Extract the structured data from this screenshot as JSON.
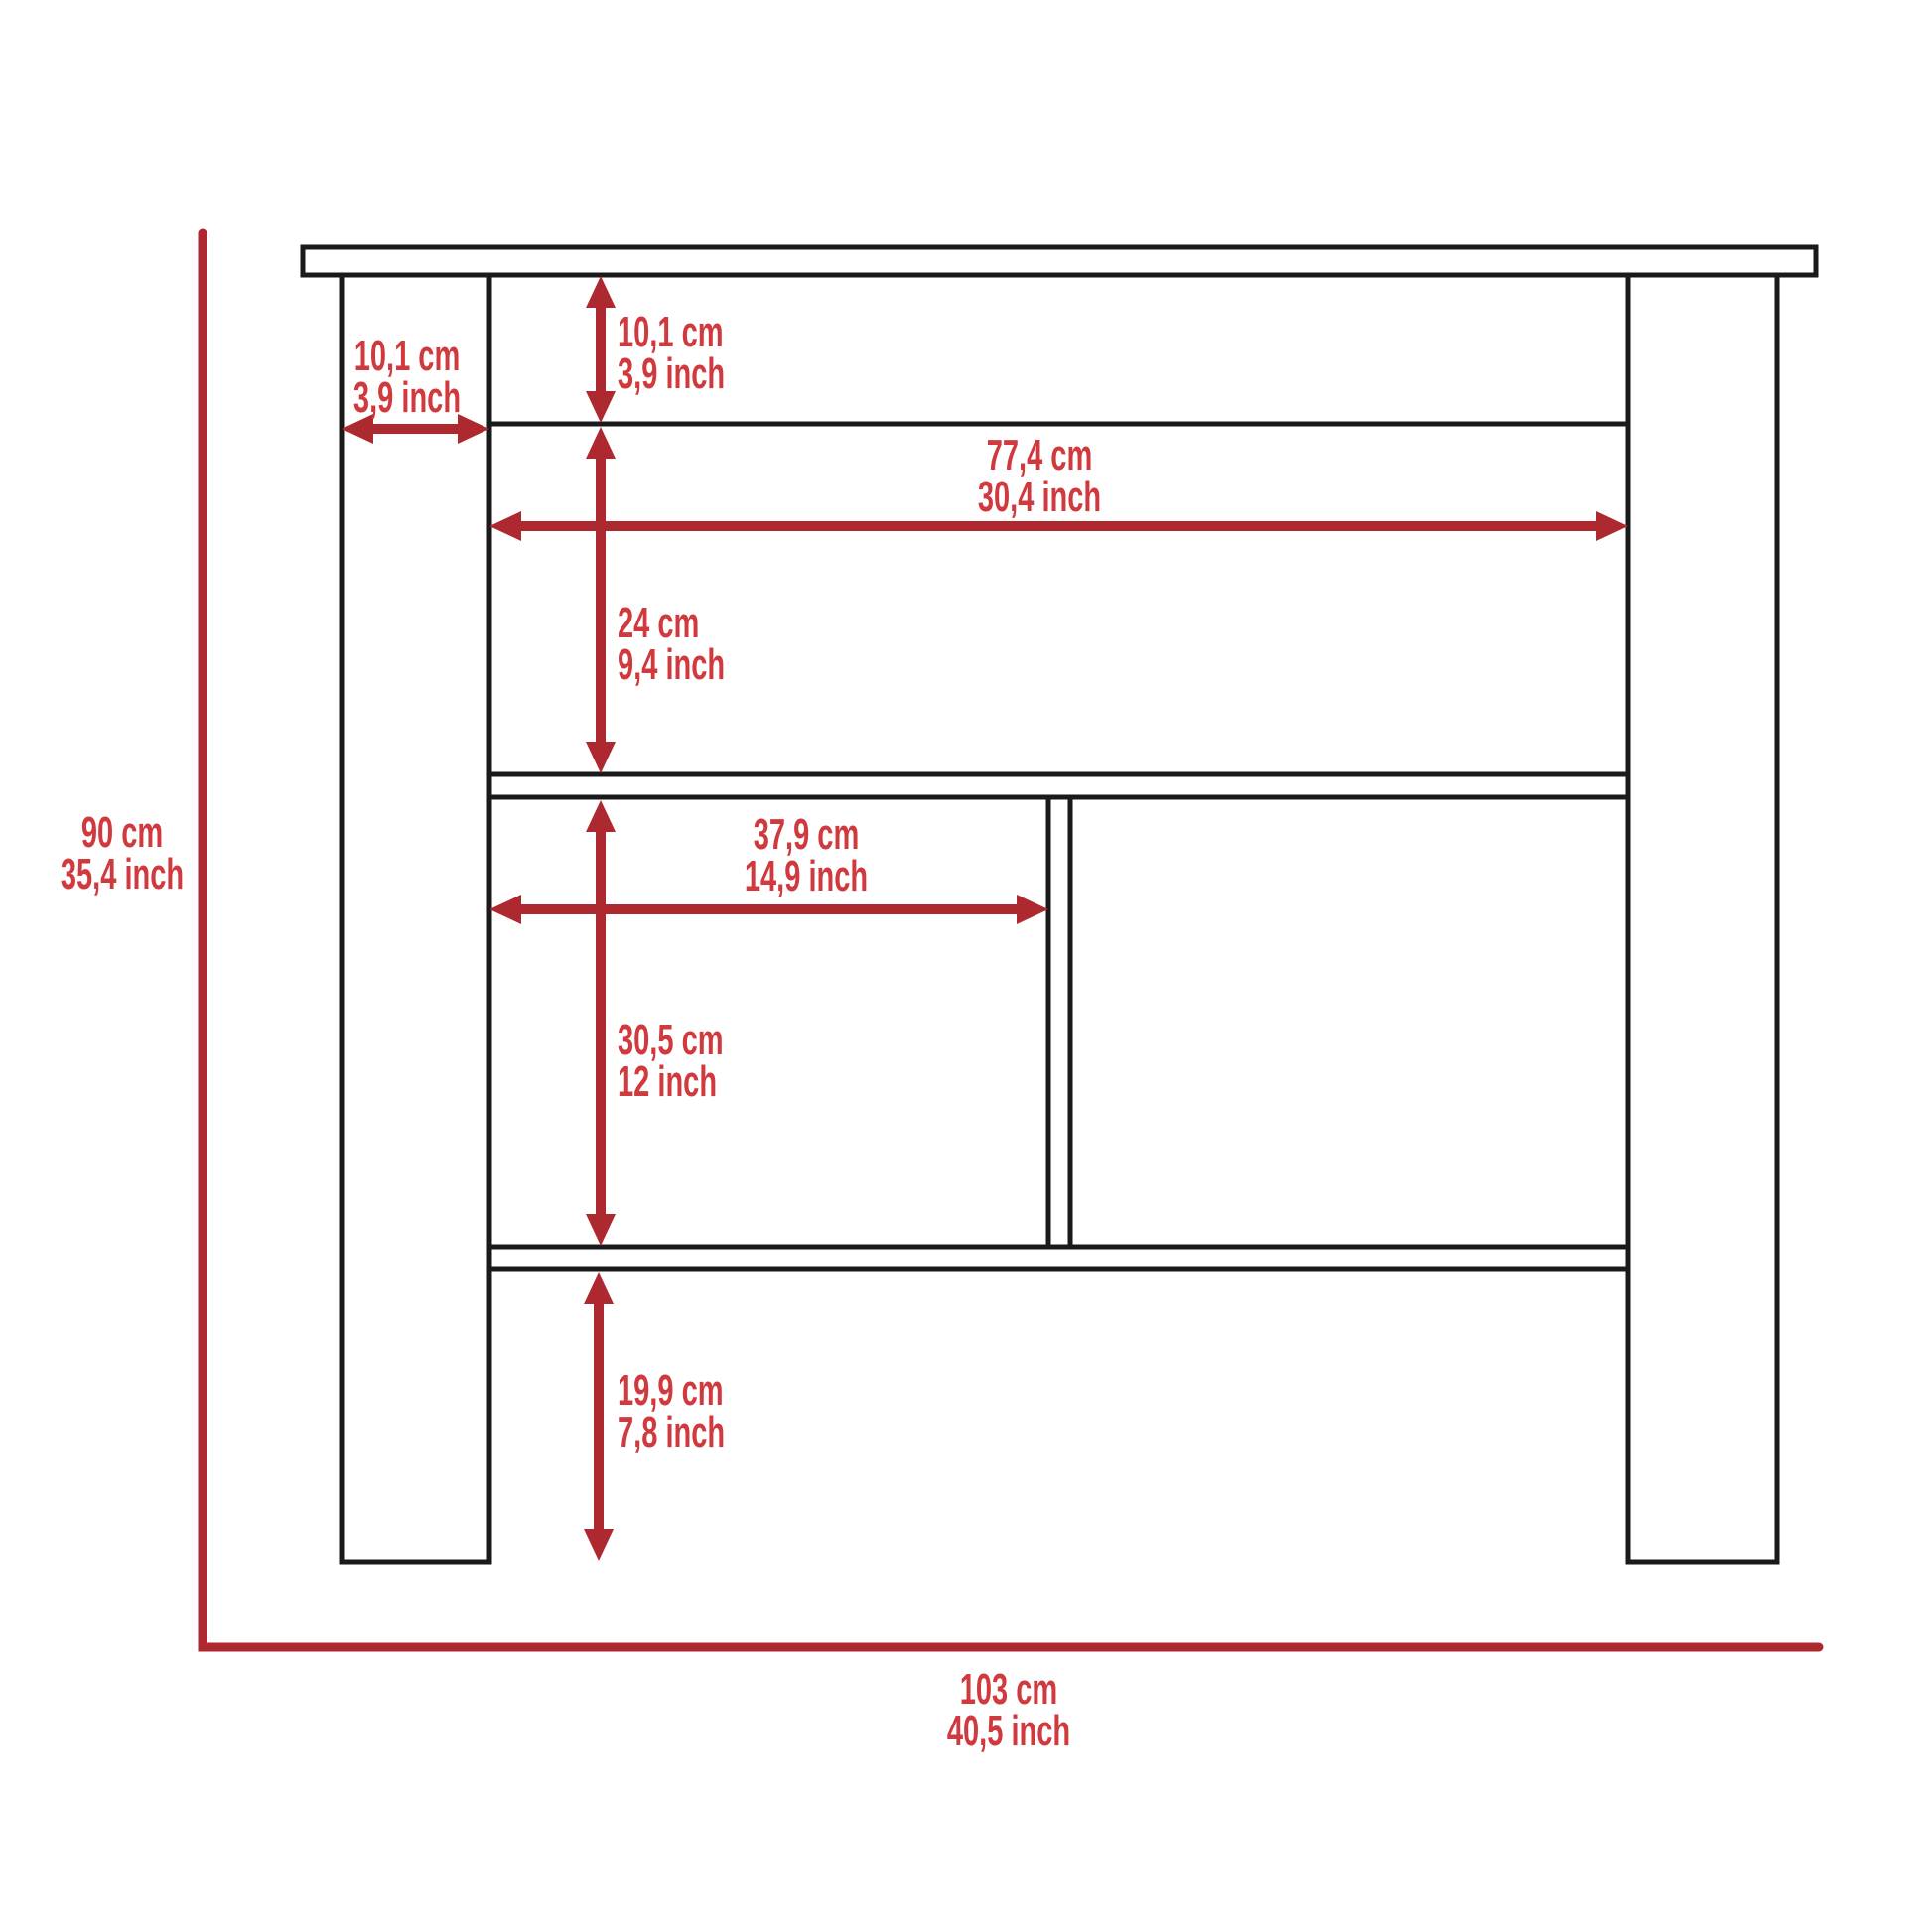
{
  "colors": {
    "dimension_text": "#d03a3e",
    "dimension_line": "#ae292f",
    "outline": "#1a1a1a"
  },
  "dimensions": {
    "overall_height": {
      "cm": "90 cm",
      "inch": "35,4 inch"
    },
    "overall_width": {
      "cm": "103 cm",
      "inch": "40,5 inch"
    },
    "leg_width": {
      "cm": "10,1 cm",
      "inch": "3,9 inch"
    },
    "apron_height": {
      "cm": "10,1 cm",
      "inch": "3,9 inch"
    },
    "interior_width": {
      "cm": "77,4 cm",
      "inch": "30,4 inch"
    },
    "upper_compartment_height": {
      "cm": "24 cm",
      "inch": "9,4 inch"
    },
    "left_compartment_width": {
      "cm": "37,9 cm",
      "inch": "14,9 inch"
    },
    "middle_compartment_height": {
      "cm": "30,5 cm",
      "inch": "12 inch"
    },
    "bottom_clearance": {
      "cm": "19,9 cm",
      "inch": "7,8 inch"
    }
  }
}
